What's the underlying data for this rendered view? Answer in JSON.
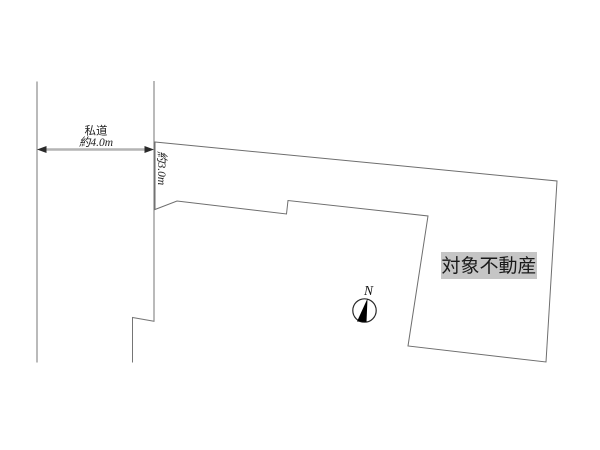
{
  "diagram": {
    "kind": "property-plot-plan",
    "labels": {
      "road_name": "私道",
      "road_width": "約4.0m",
      "frontage_width": "約3.0m",
      "property": "対象不動産",
      "north": "N"
    },
    "colors": {
      "background": "#ffffff",
      "line": "#757575",
      "dimension_line": "#b4b4b4",
      "property_label_bg": "#c5c5c5",
      "text": "#1f1f1f",
      "needle": "#000000"
    }
  }
}
